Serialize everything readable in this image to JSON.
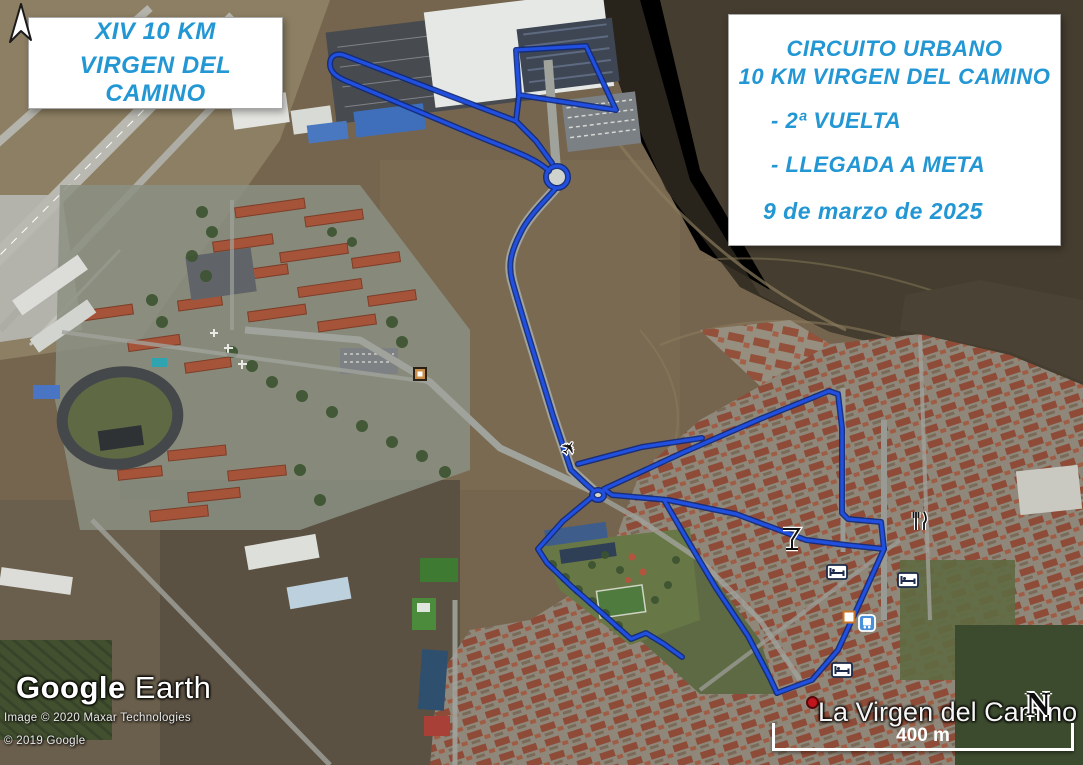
{
  "panels": {
    "top_left": {
      "line1": "XIV 10 KM",
      "line2": "VIRGEN DEL CAMINO"
    },
    "top_right": {
      "line1": "CIRCUITO URBANO",
      "line2": "10 KM VIRGEN DEL CAMINO",
      "bullet1": "- 2ª VUELTA",
      "bullet2": "- LLEGADA A META",
      "date": "9 de marzo de 2025"
    }
  },
  "branding": {
    "google": "Google",
    "earth": "Earth",
    "credit1": "Image © 2020 Maxar Technologies",
    "credit2": "© 2019 Google"
  },
  "overlay": {
    "place_label": "La Virgen del Camino",
    "north_letter": "N",
    "scale_label": "400 m"
  },
  "colors": {
    "panel_text": "#2397d3",
    "route": "#2150e0",
    "route_casing": "#10297b"
  },
  "map": {
    "icons": {
      "airplane_glyph": "✈"
    }
  }
}
